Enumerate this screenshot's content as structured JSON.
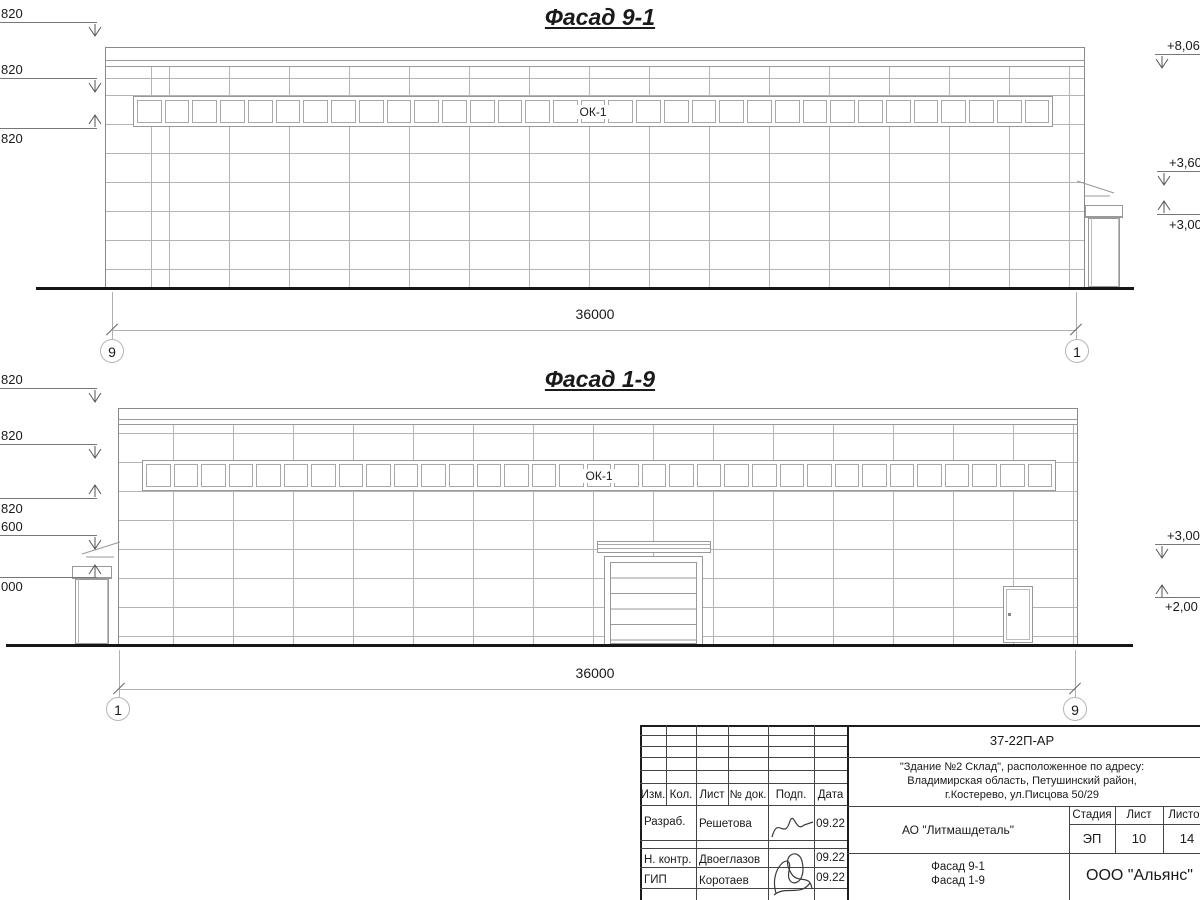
{
  "facade1": {
    "title": "Фасад 9-1",
    "window_label": "ОК-1",
    "window_count": 33,
    "dimension": "36000",
    "axis_left": "9",
    "axis_right": "1",
    "marks_left": [
      "820",
      "820",
      "820"
    ],
    "marks_right": [
      "+8,06",
      "+3,60",
      "+3,00"
    ]
  },
  "facade2": {
    "title": "Фасад 1-9",
    "window_label": "ОК-1",
    "window_count": 33,
    "dimension": "36000",
    "axis_left": "1",
    "axis_right": "9",
    "marks_left": [
      "820",
      "820",
      "820",
      "600",
      "000"
    ],
    "marks_right": [
      "+3,00",
      "+2,00"
    ]
  },
  "titleblock": {
    "doc_number": "37-22П-АР",
    "object_lines": [
      "\"Здание №2 Склад\", расположенное по адресу:",
      "Владимирская область, Петушинский район,",
      "г.Костерево, ул.Писцова 50/29"
    ],
    "client": "АО \"Литмашдеталь\"",
    "sheet_name_lines": [
      "Фасад 9-1",
      "Фасад 1-9"
    ],
    "org": "ООО \"Альянс\"",
    "stage_label": "Стадия",
    "sheet_label": "Лист",
    "sheets_label": "Листов",
    "stage": "ЭП",
    "sheet": "10",
    "sheets": "14",
    "header_cols": [
      "Изм.",
      "Кол.",
      "Лист",
      "№ док.",
      "Подп.",
      "Дата"
    ],
    "rows": [
      {
        "role": "Разраб.",
        "name": "Решетова",
        "date": "09.22"
      },
      {
        "role": "Н. контр.",
        "name": "Двоеглазов",
        "date": "09.22"
      },
      {
        "role": "ГИП",
        "name": "Коротаев",
        "date": "09.22"
      }
    ]
  }
}
